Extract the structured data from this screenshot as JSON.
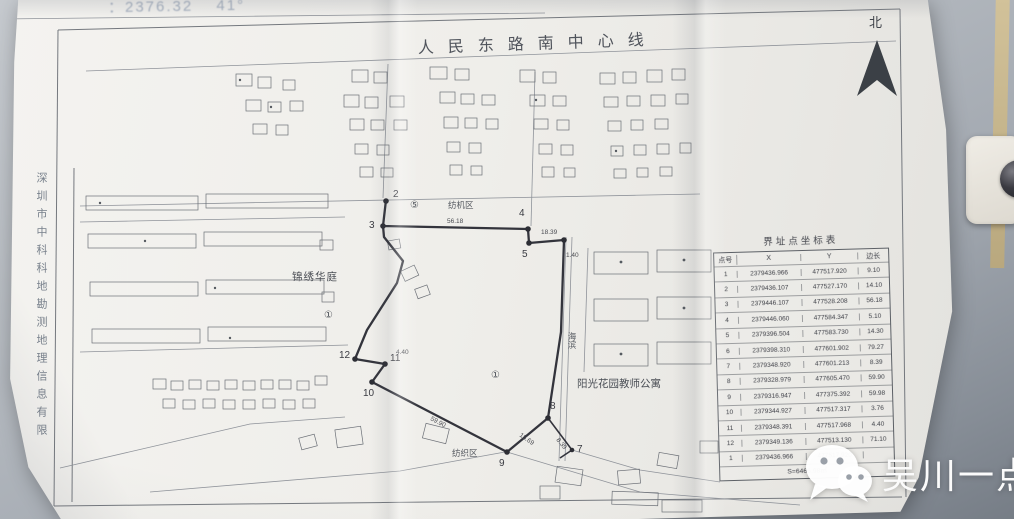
{
  "photo": {
    "top_note": "：2376.32　 41°",
    "left_margin_text": "深圳市中科科地勘测地理信息有限",
    "north_label": "北"
  },
  "map": {
    "title": "人民东路南中心线",
    "labels": {
      "estate": "锦绣华庭",
      "zone_top": "纺机区",
      "apartment": "阳光花园教师公寓",
      "zone_bottom": "纺织区",
      "road": "海滨",
      "circle_1_left": "①",
      "circle_5": "⑤",
      "circle_1_center": "①"
    },
    "point_labels": {
      "p2": "2",
      "p3": "3",
      "p4": "4",
      "p5": "5",
      "p7": "7",
      "p8": "8",
      "p9": "9",
      "p10": "10",
      "p11": "11",
      "p12": "12"
    },
    "edge_labels": {
      "e34": "56.18",
      "e46": "18.39",
      "e6": "1.40",
      "e89": "15.69",
      "e910": "59.90",
      "e11": "4.40",
      "e7": "8.39"
    }
  },
  "table": {
    "title": "界址点坐标表",
    "headers": [
      "点号",
      "X",
      "Y",
      "边长"
    ],
    "rows": [
      [
        "1",
        "2379436.966",
        "477517.920",
        "9.10"
      ],
      [
        "2",
        "2379436.107",
        "477527.170",
        "14.10"
      ],
      [
        "3",
        "2379446.107",
        "477528.208",
        "56.18"
      ],
      [
        "4",
        "2379446.060",
        "477584.347",
        "5.10"
      ],
      [
        "5",
        "2379396.504",
        "477583.730",
        "14.30"
      ],
      [
        "6",
        "2379398.310",
        "477601.902",
        "79.27"
      ],
      [
        "7",
        "2379348.920",
        "477601.213",
        "8.39"
      ],
      [
        "8",
        "2379328.979",
        "477605.470",
        "59.90"
      ],
      [
        "9",
        "2379316.947",
        "477375.392",
        "59.98"
      ],
      [
        "10",
        "2379344.927",
        "477517.317",
        "3.76"
      ],
      [
        "11",
        "2379348.391",
        "477517.968",
        "4.40"
      ],
      [
        "12",
        "2379349.136",
        "477513.130",
        "71.10"
      ],
      [
        "1",
        "2379436.966",
        "477517.920",
        ""
      ]
    ],
    "total": "S=6466.98㎡"
  },
  "watermark": {
    "icon": "wechat-icon",
    "text": "吴川一点通"
  },
  "colors": {
    "paper": "#f1f0ed",
    "wall": "#b3b8be",
    "boundary_line": "#33343c",
    "door_frame": "#c3b287",
    "watermark_text": "#fbfbfb"
  }
}
